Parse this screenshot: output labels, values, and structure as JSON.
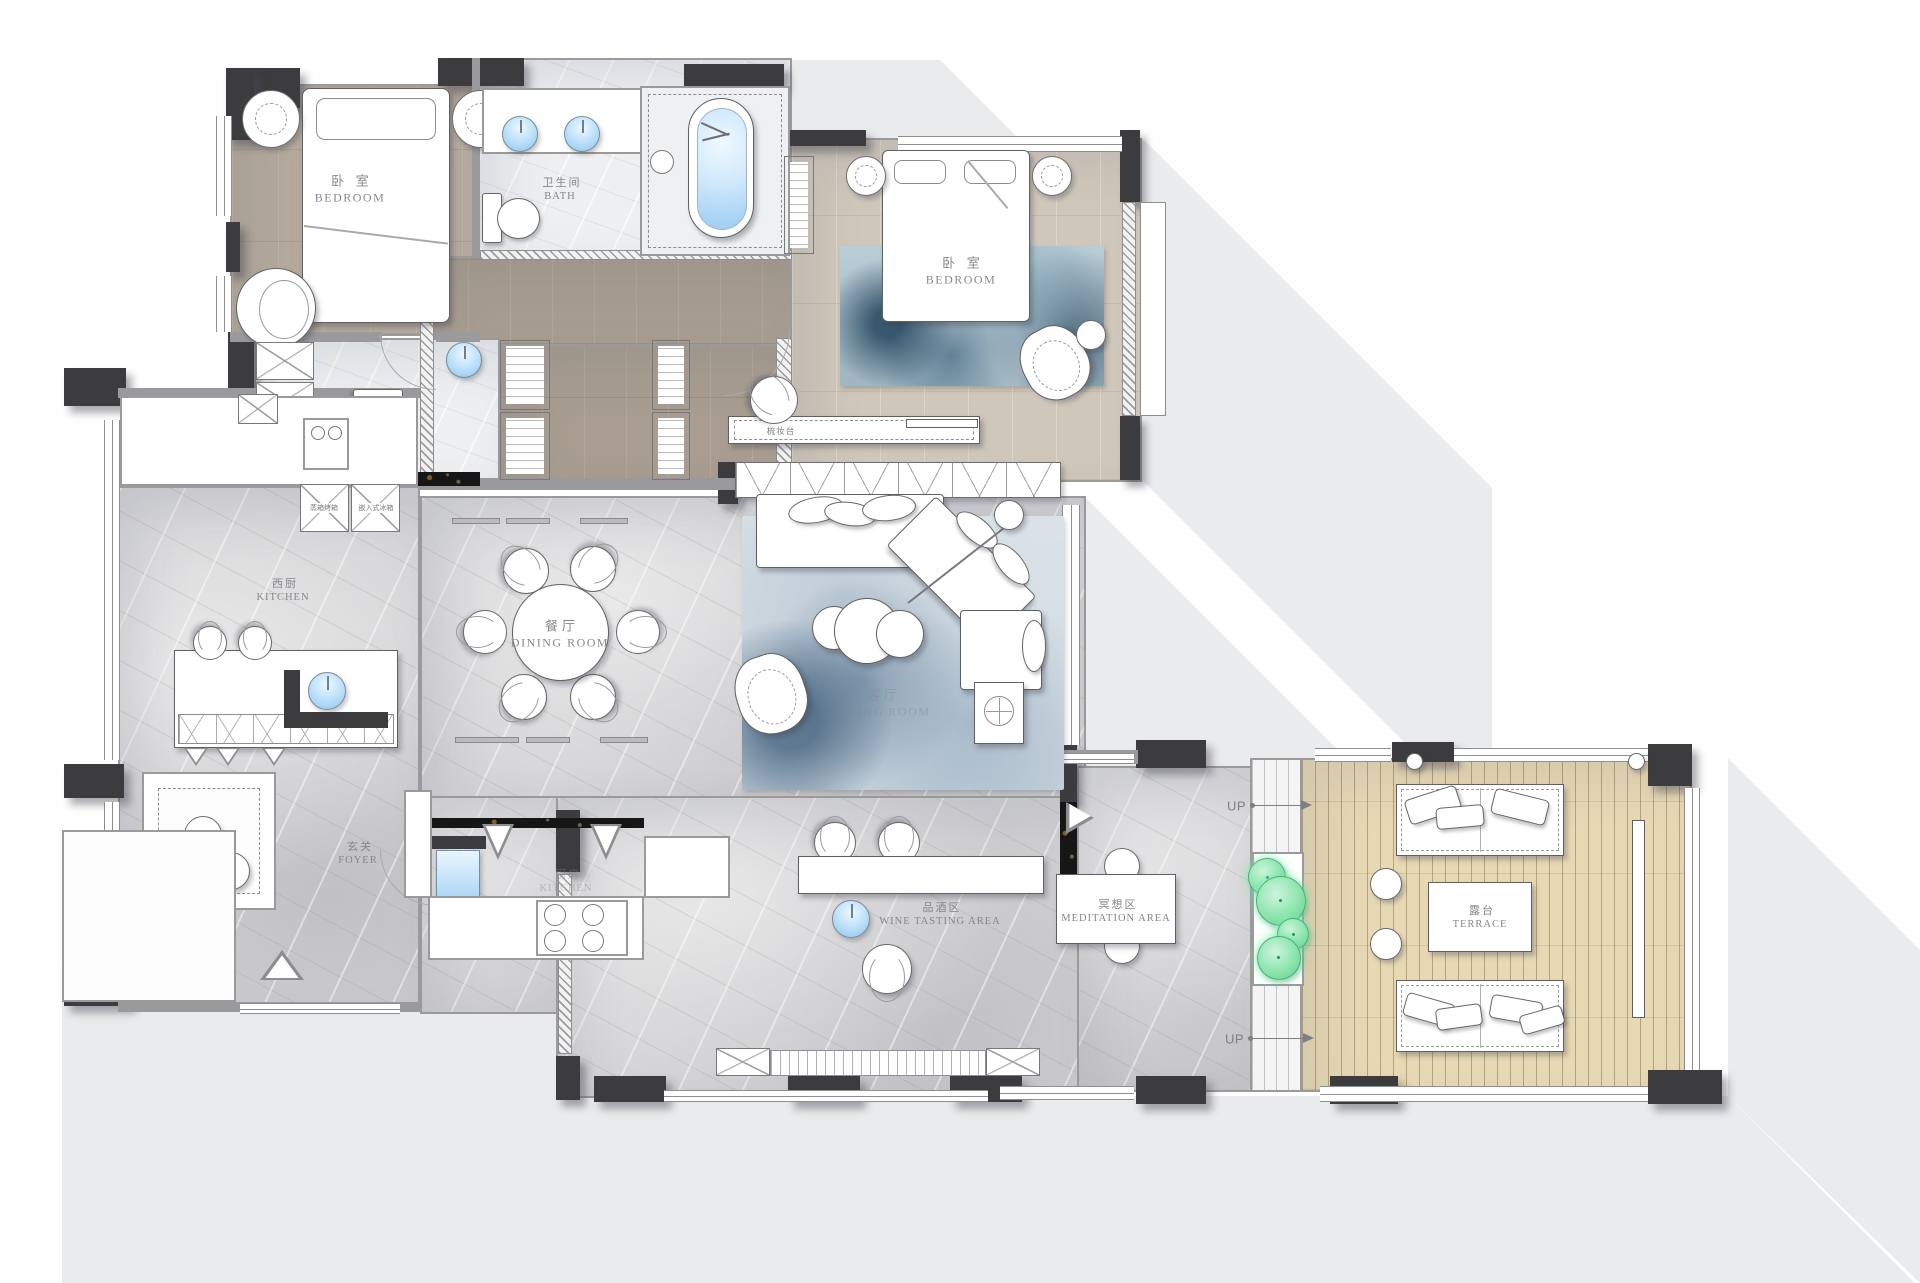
{
  "rooms": {
    "bedroom1": {
      "zh": "卧 室",
      "en": "BEDROOM"
    },
    "bath": {
      "zh": "卫生间",
      "en": "BATH"
    },
    "bedroom2": {
      "zh": "卧 室",
      "en": "BEDROOM"
    },
    "west_kitchen": {
      "zh": "西厨",
      "en": "KITCHEN"
    },
    "dining": {
      "zh": "餐厅",
      "en": "DINING ROOM"
    },
    "living": {
      "zh": "客厅",
      "en": "LIVING ROOM"
    },
    "foyer": {
      "zh": "玄关",
      "en": "FOYER"
    },
    "kitchen": {
      "zh": "厨房",
      "en": "KITCHEN"
    },
    "wine": {
      "zh": "品酒区",
      "en": "WINE TASTING AREA"
    },
    "meditation": {
      "zh": "冥想区",
      "en": "MEDITATION AREA"
    },
    "terrace": {
      "zh": "露台",
      "en": "TERRACE"
    }
  },
  "annotations": {
    "dresser": "梳妆台",
    "steam_oven": "蒸箱烤箱",
    "fridge": "嵌入式冰箱",
    "up_upper": "UP",
    "up_lower": "UP"
  },
  "colors": {
    "wall": "#3c3c3f",
    "marble": "#d4d4d6",
    "wood": "#b4a99c",
    "wood_light": "#cfc7ba",
    "deck": "#e8d9b5",
    "water_fixture": "#a9d3f2",
    "plant": "#8ce5ae",
    "shadow": "#e9ebed",
    "label_text": "#84878a"
  }
}
